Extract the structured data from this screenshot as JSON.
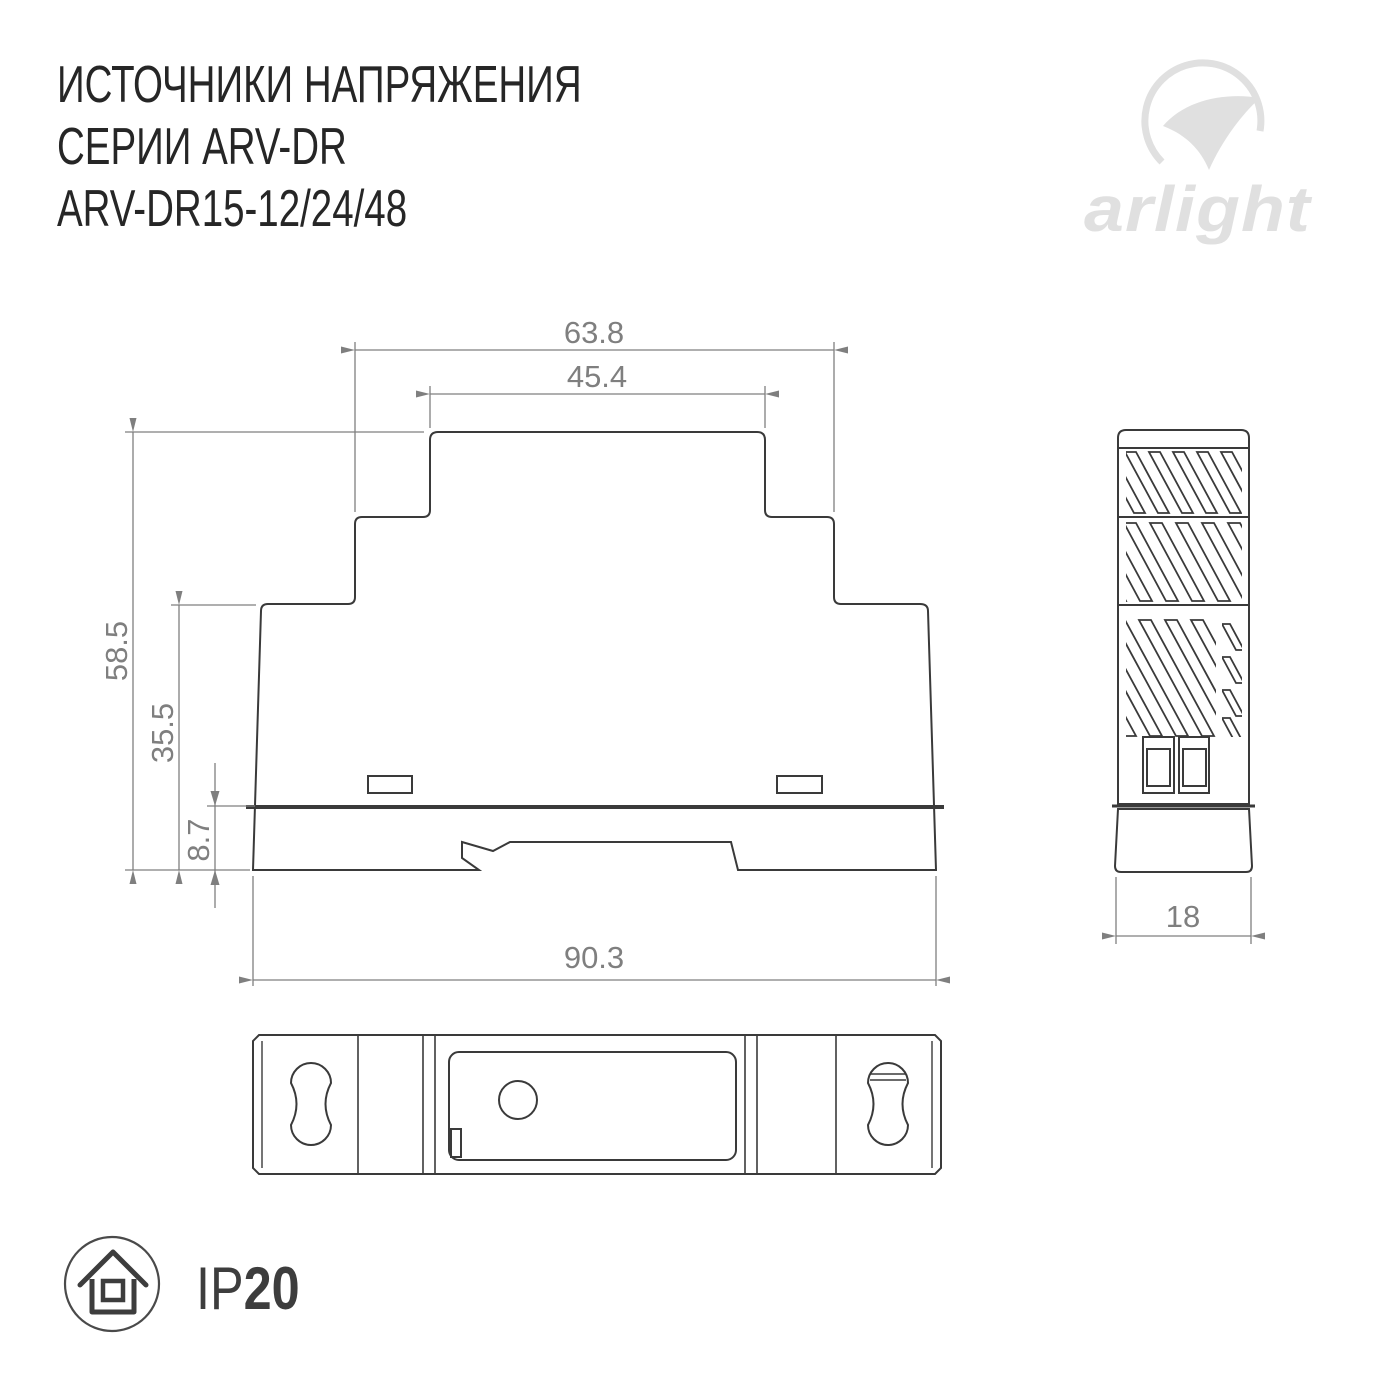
{
  "header": {
    "title_line1": "ИСТОЧНИКИ НАПРЯЖЕНИЯ",
    "title_line2": "СЕРИИ ARV-DR",
    "title_line3": "ARV-DR15-12/24/48"
  },
  "logo": {
    "text": "arlight"
  },
  "drawing": {
    "front_view": {
      "dim_step_width": "63.8",
      "dim_cap_width": "45.4",
      "dim_total_height": "58.5",
      "dim_body_height": "35.5",
      "dim_foot_height": "8.7",
      "dim_total_width": "90.3"
    },
    "side_view": {
      "dim_width": "18"
    }
  },
  "footer": {
    "ip_prefix": "IP",
    "ip_value": "20"
  },
  "colors": {
    "outline": "#3a3a3a",
    "dimension": "#7f7f7f",
    "logo_gray": "#e0e0e0",
    "title_text": "#262626"
  }
}
